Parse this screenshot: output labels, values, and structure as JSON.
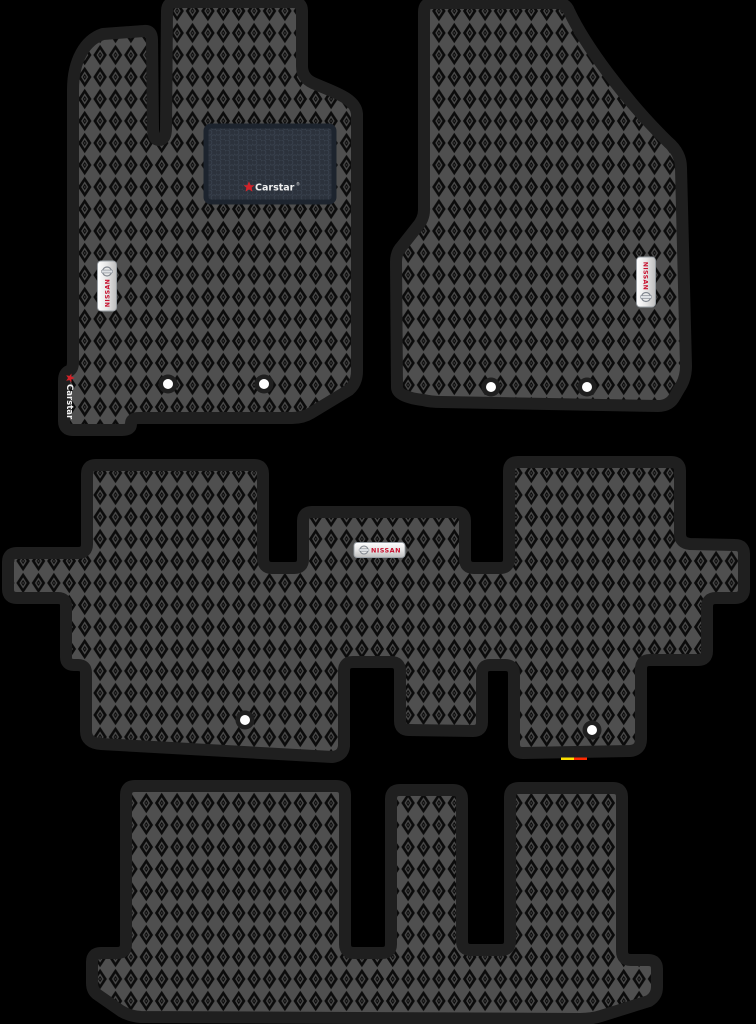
{
  "scene": {
    "type": "product-photo",
    "subject": "Set of black EVA diamond-pattern car floor mats for a 3-row Nissan vehicle",
    "background_color": "#000000"
  },
  "colors": {
    "mat_lattice": "#4f4f4f",
    "mat_cell": "#0b0b0b",
    "mat_border": "#1f1f1f",
    "heel_pad_fill": "#2c323c",
    "heel_pad_border": "#1d242e",
    "badge_background": "#e9e9e9",
    "nissan_red": "#c8102e",
    "carstar_red": "#d2232a",
    "fastener_hole": "#ffffff"
  },
  "branding": {
    "nissan_badge_text": "NISSAN",
    "heel_logo_text": "Carstar",
    "heel_logo_reg": "®",
    "edge_logo_text": "Carstar"
  },
  "mats": [
    {
      "name": "driver-front-mat",
      "badges": [
        "NISSAN",
        "Carstar heel pad",
        "Carstar edge print"
      ],
      "fastener_holes": 2
    },
    {
      "name": "passenger-front-mat",
      "badges": [
        "NISSAN"
      ],
      "fastener_holes": 2
    },
    {
      "name": "second-row-mat",
      "badges": [
        "NISSAN"
      ],
      "fastener_holes": 2
    },
    {
      "name": "third-row-mat",
      "badges": [],
      "fastener_holes": 0
    }
  ]
}
